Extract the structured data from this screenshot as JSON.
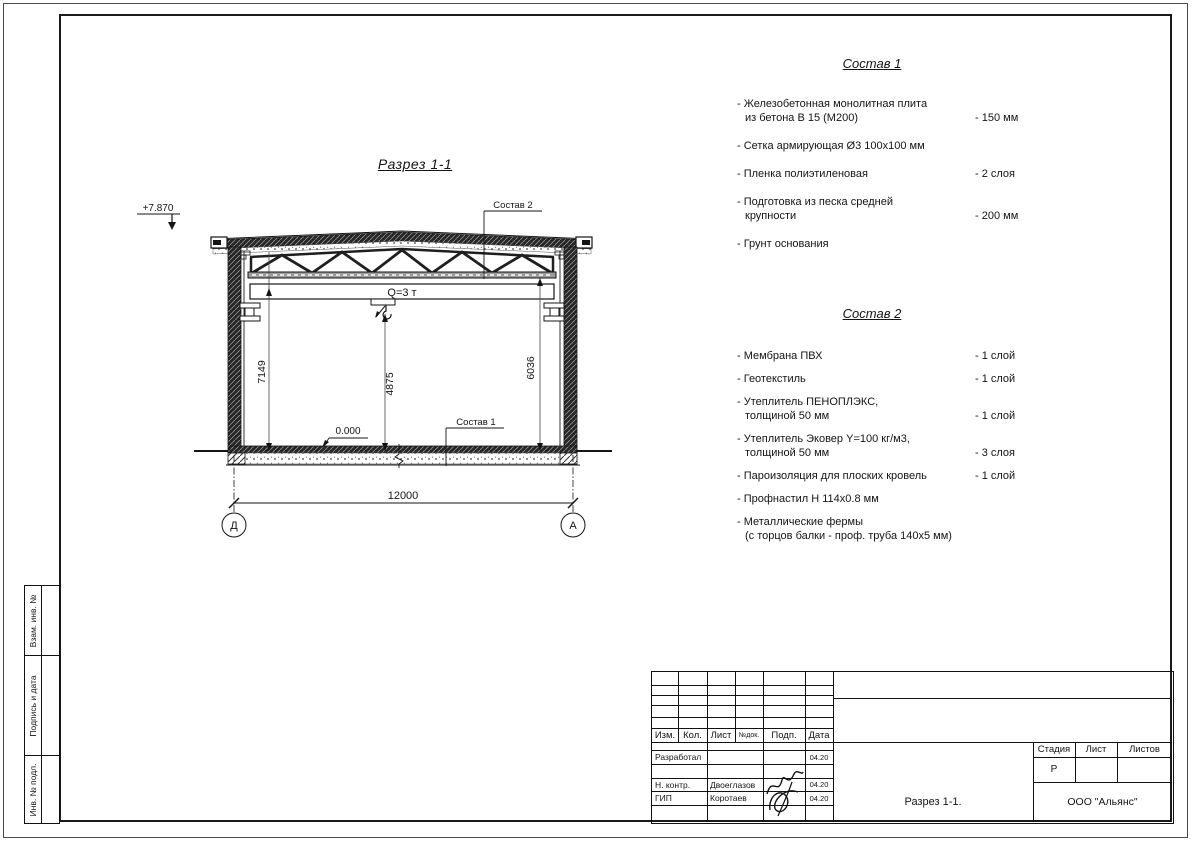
{
  "page": {
    "section_title": "Разрез 1-1"
  },
  "drawing": {
    "elevation_top": "+7.870",
    "elevation_zero": "0.000",
    "crane_capacity": "Q=3 т",
    "dim_left": "7149",
    "dim_hook": "4875",
    "dim_right": "6036",
    "dim_span": "12000",
    "axis_left": "Д",
    "axis_right": "А",
    "leader_sostav1": "Состав 1",
    "leader_sostav2": "Состав 2"
  },
  "composition1": {
    "title": "Состав 1",
    "items": [
      {
        "l1": "- Железобетонная  монолитная плита",
        "l2": "из бетона В 15 (М200)",
        "value": "- 150 мм"
      },
      {
        "l1": "- Сетка армирующая Ø3 100х100 мм",
        "l2": "",
        "value": ""
      },
      {
        "l1": "- Пленка полиэтиленовая",
        "l2": "",
        "value": "-  2 слоя"
      },
      {
        "l1": "- Подготовка из песка средней",
        "l2": "крупности",
        "value": "- 200 мм"
      },
      {
        "l1": "- Грунт основания",
        "l2": "",
        "value": ""
      }
    ]
  },
  "composition2": {
    "title": "Состав 2",
    "items": [
      {
        "l1": "- Мембрана ПВХ",
        "l2": "",
        "value": "- 1 слой"
      },
      {
        "l1": "- Геотекстиль",
        "l2": "",
        "value": "- 1 слой"
      },
      {
        "l1": "- Утеплитель ПЕНОПЛЭКС,",
        "l2": "толщиной 50 мм",
        "value": "- 1 слой"
      },
      {
        "l1": "- Утеплитель Эковер Y=100 кг/м3,",
        "l2": "толщиной 50 мм",
        "value": "- 3 слоя"
      },
      {
        "l1": "- Пароизоляция для плоских кровель",
        "l2": "",
        "value": "- 1 слой"
      },
      {
        "l1": "- Профнастил Н 114х0.8 мм",
        "l2": "",
        "value": ""
      },
      {
        "l1": "- Металлические фермы",
        "l2": "(с торцов балки - проф. труба 140х5 мм)",
        "value": ""
      }
    ]
  },
  "titleblock": {
    "header": {
      "izm": "Изм.",
      "kol": "Кол.",
      "list": "Лист",
      "ndoc": "№док.",
      "podp": "Подп.",
      "data": "Дата"
    },
    "rows": [
      {
        "role": "Разработал",
        "name": "",
        "date": "04.20"
      },
      {
        "role": "Н. контр.",
        "name": "Двоеглазов",
        "date": "04.20"
      },
      {
        "role": "ГИП",
        "name": "Коротаев",
        "date": "04.20"
      }
    ],
    "stage_label": "Стадия",
    "sheet_label": "Лист",
    "sheets_label": "Листов",
    "stage_value": "Р",
    "doc_title": "Разрез 1-1.",
    "company": "ООО \"Альянс\""
  },
  "side_panel": {
    "labels": [
      "Взам. инв. №",
      "Подпись и дата",
      "Инв. № подл."
    ]
  },
  "colors": {
    "line": "#1a1a1a",
    "paper": "#ffffff"
  }
}
